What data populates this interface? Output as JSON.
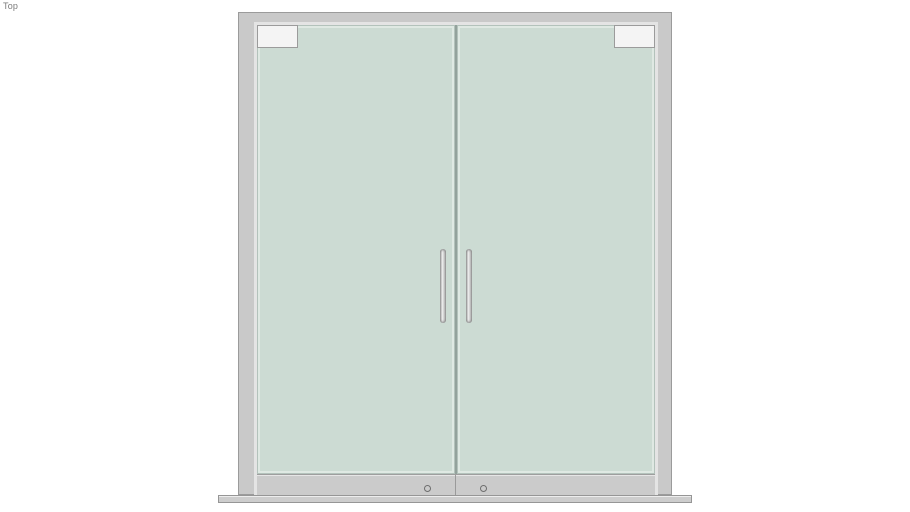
{
  "app": {
    "view_label": "Top"
  },
  "model": {
    "name": "double-glass-swing-door",
    "parts": {
      "frame": "aluminum door frame",
      "leaf_left": "left glass leaf",
      "leaf_right": "right glass leaf",
      "patch_left": "top patch fitting left",
      "patch_right": "top patch fitting right",
      "handle_left": "pull handle left",
      "handle_right": "pull handle right",
      "bottom_rail": "bottom patch rail",
      "pivot_left": "floor pivot left",
      "pivot_right": "floor pivot right",
      "threshold": "floor threshold"
    }
  },
  "colors": {
    "background": "#ffffff",
    "frame-fill": "#c9c9c9",
    "frame-outline": "#9b9b9b",
    "frame-highlight": "#e4e4e4",
    "glass-fill": "#ccdbd3",
    "glass-edge": "#dfe9e3",
    "glass-outline": "#b3c2bb",
    "gap-line": "#93a29c",
    "fitting-fill": "#f4f4f4",
    "rail-fill": "#cbcbcb",
    "rail-line": "#9e9e9e",
    "threshold-fill": "#cdcdcd",
    "handle-dark": "#8f8f8f",
    "handle-light": "#f0f0f0",
    "handle-mid": "#c0c0c0",
    "pivot-outline": "#6e6e6e",
    "label-text": "#7a7a7a"
  }
}
